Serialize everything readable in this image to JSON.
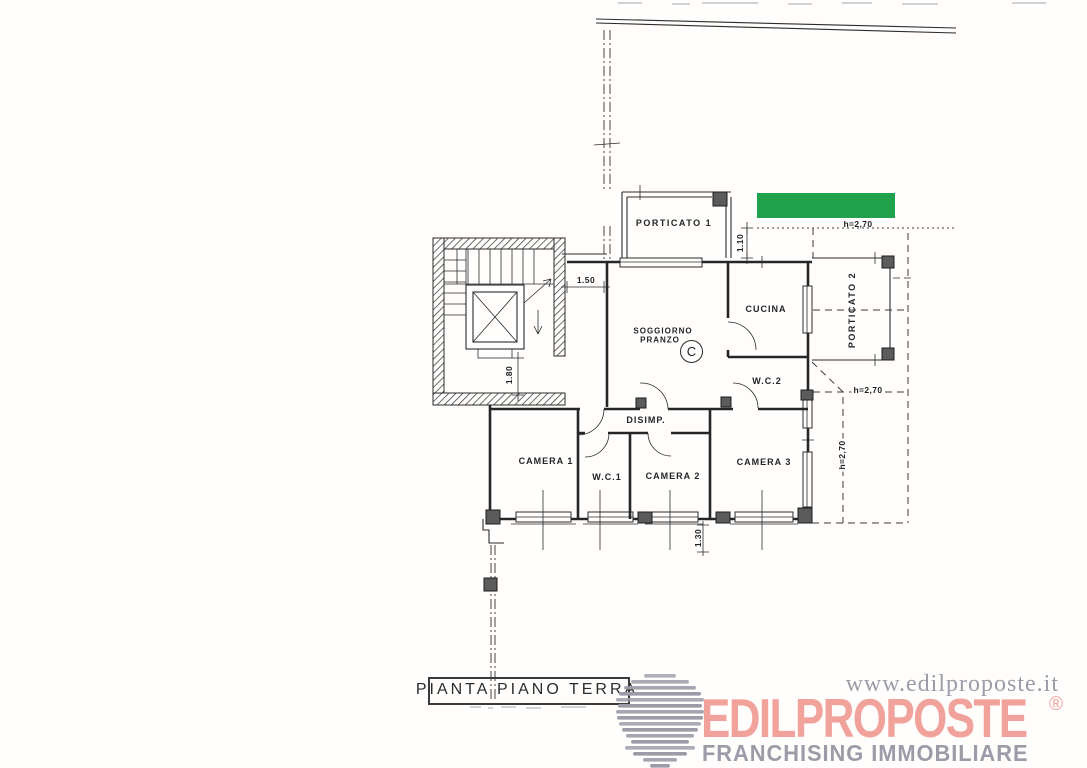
{
  "plan": {
    "title": "PIANTA PIANO TERRA",
    "rooms": {
      "porticato1": "PORTICATO 1",
      "soggiorno_line1": "SOGGIORNO",
      "soggiorno_line2": "PRANZO",
      "class_letter": "C",
      "cucina": "CUCINA",
      "wc2": "W.C.2",
      "porticato2": "PORTICATO 2",
      "disimp": "DISIMP.",
      "camera1": "CAMERA 1",
      "wc1": "W.C.1",
      "camera2": "CAMERA 2",
      "camera3": "CAMERA 3"
    },
    "dimensions": {
      "landing_width": "1.50",
      "stair_width": "1.80",
      "porch_depth": "1.10",
      "window_width": "1.30",
      "height_top": "h=2,70",
      "height_bottom": "h=2,70",
      "height_side": "h=2,70"
    }
  },
  "highlight": {
    "color": "#1fa24b"
  },
  "branding": {
    "website": "www.edilproposte.it",
    "brand": "EDILPROPOSTE",
    "registered_mark": "®",
    "tagline": "FRANCHISING IMMOBILIARE",
    "brand_color": "#f1a29b",
    "gray_color": "#9b9ca8"
  }
}
